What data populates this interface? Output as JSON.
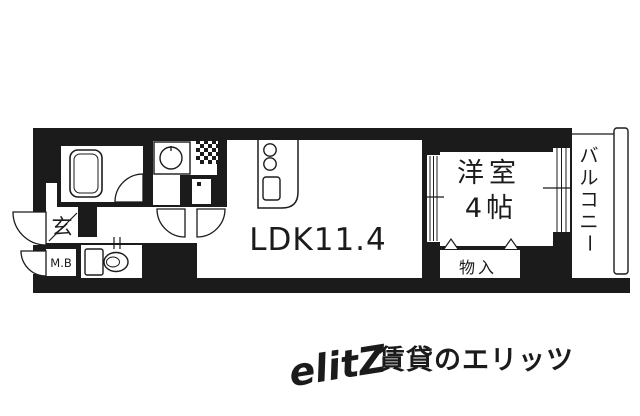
{
  "floorplan": {
    "wall_color": "#1b1b1b",
    "rooms": {
      "ldk": {
        "label": "LDK11.4"
      },
      "western_room": {
        "name_label": "洋室",
        "size_label": "4帖"
      },
      "closet": {
        "label": "物入"
      },
      "balcony": {
        "label": "バルコニー",
        "chars": [
          "バ",
          "ル",
          "コ",
          "ニ",
          "ー"
        ]
      },
      "entrance": {
        "label": "玄"
      },
      "meter_box": {
        "label": "M.B"
      }
    }
  },
  "watermark": {
    "logo_text": "elitZ",
    "caption": "賃貸のエリッツ",
    "color": "#e3e3e3"
  }
}
